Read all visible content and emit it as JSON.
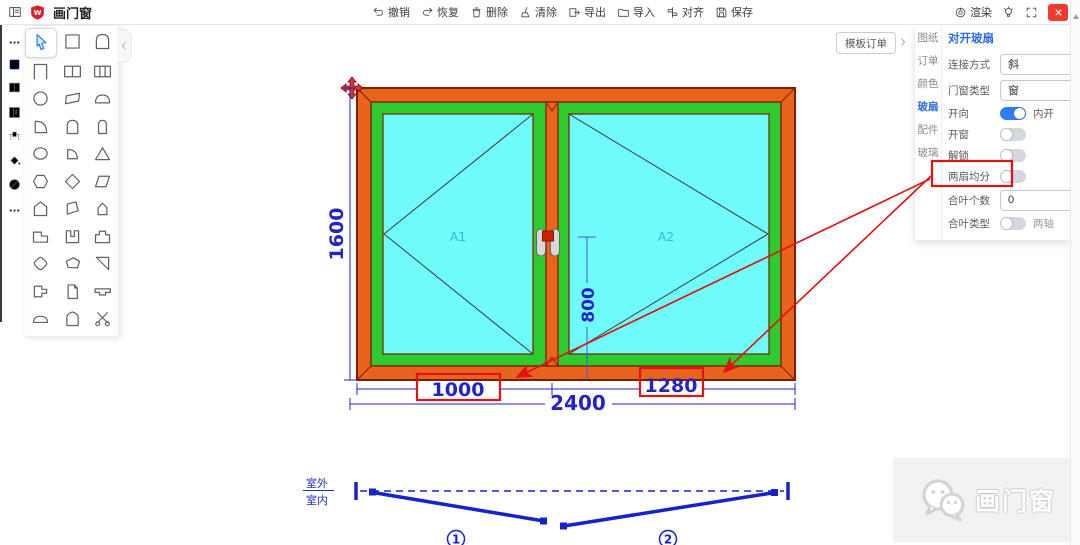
{
  "app": {
    "menu_icon": "menu-icon",
    "logo_icon": "shield-logo-icon",
    "logo_letter": "W",
    "title": "画门窗"
  },
  "toolbar": {
    "items": [
      {
        "icon": "undo-icon",
        "label": "撤销"
      },
      {
        "icon": "redo-icon",
        "label": "恢复"
      },
      {
        "icon": "trash-icon",
        "label": "删除"
      },
      {
        "icon": "broom-icon",
        "label": "清除"
      },
      {
        "icon": "export-icon",
        "label": "导出"
      },
      {
        "icon": "import-icon",
        "label": "导入"
      },
      {
        "icon": "align-icon",
        "label": "对齐"
      },
      {
        "icon": "save-icon",
        "label": "保存"
      }
    ],
    "right_items": [
      {
        "icon": "render-icon",
        "label": "渲染"
      },
      {
        "icon": "bulb-icon",
        "label": ""
      },
      {
        "icon": "fullscreen-icon",
        "label": ""
      }
    ],
    "close_icon": "close-icon"
  },
  "left_strip": {
    "items": [
      "more-dots-icon",
      "square-tool-icon",
      "split-pane-icon",
      "panel-list-icon",
      "workbench-icon",
      "paint-bucket-icon",
      "slash-circle-icon",
      "more-dots-icon"
    ],
    "active_index": 1
  },
  "palette": {
    "collapse_icon": "chevron-left-icon",
    "active_tool": "cursor",
    "tools": [
      "cursor",
      "square",
      "arch-door",
      "door-frame",
      "window-double",
      "window-triple",
      "circle",
      "parallelogram",
      "dome",
      "quarter-circle",
      "round-arch",
      "narrow-arch",
      "ellipse",
      "quarter-pie",
      "triangle",
      "hexagon",
      "diamond",
      "skew-rect",
      "pentagon",
      "skew-poly",
      "small-pentagon",
      "step-rect",
      "u-shape",
      "tab-rect",
      "rounded-diamond",
      "blob",
      "right-triangle",
      "p-shape",
      "folded-sheet",
      "t-shape",
      "low-dome",
      "pointed-arch",
      "scissors"
    ]
  },
  "canvas": {
    "template_order_button": "模板订单",
    "panel_expand_icon": "chevron-right-icon",
    "drawing": {
      "pane_labels": {
        "a1": "A1",
        "a2": "A2"
      },
      "dimensions": {
        "height": "1600",
        "total_width": "2400",
        "left_sash_width": "1000",
        "right_sash_width": "1280",
        "handle_height": "800"
      }
    },
    "plan": {
      "outside_label": "室外",
      "inside_label": "室内",
      "sash_numbers": [
        "1",
        "2"
      ]
    }
  },
  "right_panel": {
    "tabs": [
      {
        "label": "图纸",
        "active": false
      },
      {
        "label": "订单",
        "active": false
      },
      {
        "label": "颜色",
        "active": false
      },
      {
        "label": "玻扇",
        "active": true
      },
      {
        "label": "配件",
        "active": false
      },
      {
        "label": "玻璃",
        "active": false
      }
    ],
    "title": "对开玻扇",
    "fields": [
      {
        "key": "connect",
        "label": "连接方式",
        "type": "select",
        "value": "斜"
      },
      {
        "key": "window-type",
        "label": "门窗类型",
        "type": "select",
        "value": "窗"
      },
      {
        "key": "open-direction",
        "label": "开向",
        "type": "toggle",
        "on": true,
        "suffix": "内开"
      },
      {
        "key": "open-sash",
        "label": "开窗",
        "type": "toggle",
        "on": false,
        "suffix": ""
      },
      {
        "key": "unlock",
        "label": "解锁",
        "type": "toggle",
        "on": false,
        "suffix": ""
      },
      {
        "key": "equal-split",
        "label": "两扇均分",
        "type": "toggle",
        "on": false,
        "suffix": "",
        "highlighted": true
      },
      {
        "key": "hinge-count",
        "label": "合叶个数",
        "type": "select",
        "value": "0"
      },
      {
        "key": "hinge-type",
        "label": "合叶类型",
        "type": "toggle",
        "on": false,
        "suffix": "两轴"
      }
    ]
  },
  "watermark": {
    "icon": "wechat-icon",
    "text": "画门窗"
  },
  "colors": {
    "frame_orange": "#E8641C",
    "frame_outline": "#7E1E00",
    "sash_green": "#2ECB2E",
    "glass_cyan": "#70FBFB",
    "dimension_blue": "#2323C8",
    "annotation_red": "#E01212",
    "plan_blue": "#1822CC",
    "toggle_on_blue": "#2E7CF6",
    "accent_blue": "#2A6BE8",
    "close_red": "#EE3B2C",
    "logo_red": "#D6232A",
    "pane_label_blue": "#35B6DF"
  }
}
